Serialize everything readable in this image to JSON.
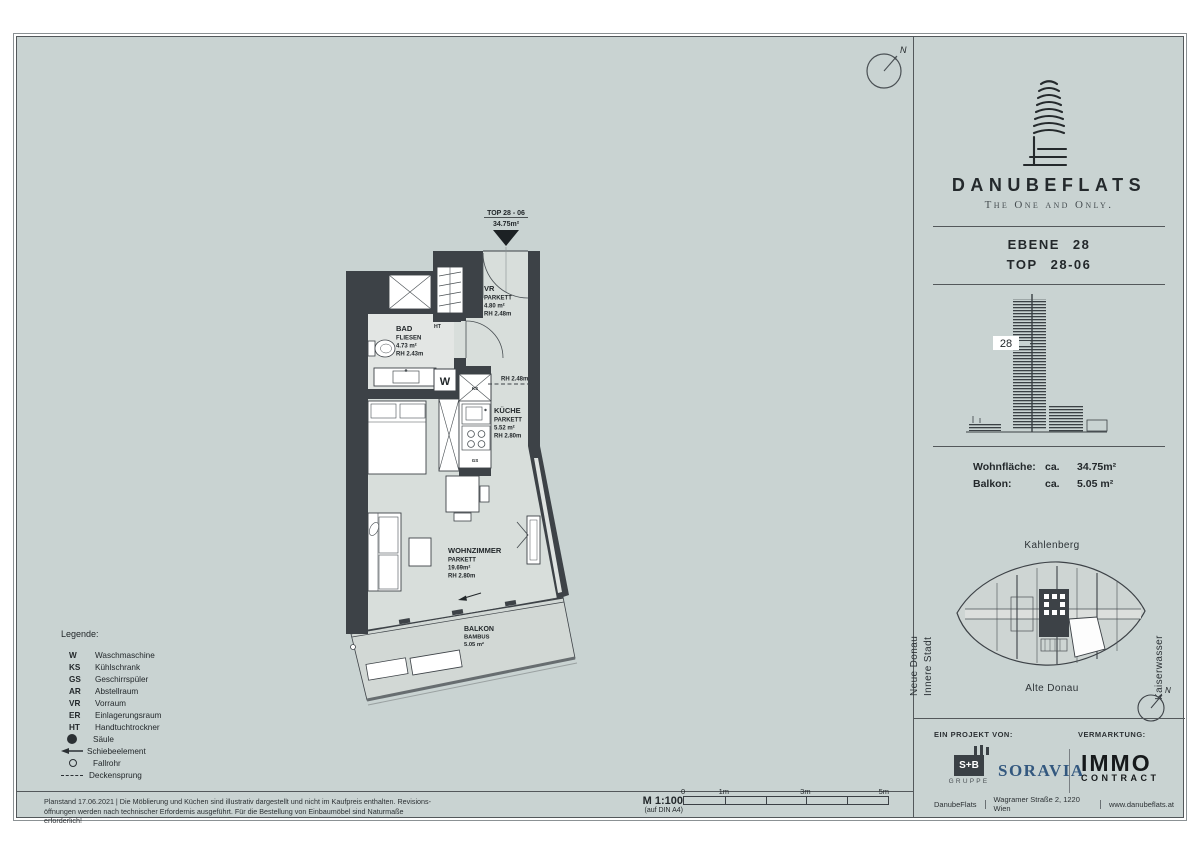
{
  "colors": {
    "sheet_bg": "#c9d3d2",
    "wall": "#3d4247",
    "soravia_blue": "#33587f",
    "immo_black": "#16191b",
    "sb_logo_bg": "#3a4045"
  },
  "north_label": "N",
  "plan": {
    "callout": {
      "line1": "TOP 28 - 06",
      "line2": "34.75m²"
    },
    "rooms": {
      "vr": {
        "name": "VR",
        "floor": "PARKETT",
        "area": "4.80 m²",
        "rh": "RH 2.48m"
      },
      "bad": {
        "name": "BAD",
        "floor": "FLIESEN",
        "area": "4.73 m²",
        "rh": "RH 2.43m"
      },
      "kueche": {
        "name": "KÜCHE",
        "floor": "PARKETT",
        "area": "5.52 m²",
        "rh": "RH 2.80m"
      },
      "wohnzimmer": {
        "name": "WOHNZIMMER",
        "floor": "PARKETT",
        "area": "19.69m²",
        "rh": "RH 2.80m"
      },
      "balkon": {
        "name": "BALKON",
        "floor": "BAMBUS",
        "area": "5.05 m²"
      }
    },
    "marks": {
      "ht": "HT",
      "w": "W",
      "ks": "KS",
      "gs": "GS",
      "deckensprung": "RH 2.48m"
    }
  },
  "legend": {
    "title": "Legende:",
    "items": [
      {
        "abbr": "W",
        "label": "Waschmaschine"
      },
      {
        "abbr": "KS",
        "label": "Kühlschrank"
      },
      {
        "abbr": "GS",
        "label": "Geschirrspüler"
      },
      {
        "abbr": "AR",
        "label": "Abstellraum"
      },
      {
        "abbr": "VR",
        "label": "Vorraum"
      },
      {
        "abbr": "ER",
        "label": "Einlagerungsraum"
      },
      {
        "abbr": "HT",
        "label": "Handtuchtrockner"
      }
    ],
    "symbols": [
      {
        "label": "Säule"
      },
      {
        "label": "Schiebeelement"
      },
      {
        "label": "Fallrohr"
      },
      {
        "label": "Deckensprung"
      }
    ]
  },
  "footer": {
    "note_line1": "Planstand 17.06.2021 | Die Möblierung und Küchen sind illustrativ dargestellt und nicht im Kaufpreis enthalten. Revisions-",
    "note_line2": "öffnungen werden nach technischer Erfordernis ausgeführt. Für die Bestellung von Einbaumöbel sind Naturmaße erforderlich!",
    "scale": {
      "label": "M 1:100",
      "sub": "(auf DIN A4)",
      "t0": "0",
      "t1": "1m",
      "t3": "3m",
      "t5": "5m"
    }
  },
  "sidebar": {
    "brand": {
      "name": "DANUBEFLATS",
      "tagline": "The One and Only."
    },
    "unit": {
      "level_label": "EBENE",
      "level_value": "28",
      "top_label": "TOP",
      "top_value": "28-06"
    },
    "elevation": {
      "floor": "28"
    },
    "areas": {
      "w_label": "Wohnfläche:",
      "w_ca": "ca.",
      "w_value": "34.75m²",
      "b_label": "Balkon:",
      "b_ca": "ca.",
      "b_value": "5.05 m²"
    },
    "map": {
      "north": "Kahlenberg",
      "west1": "Neue Donau",
      "west2": "Innere Stadt",
      "east": "Kaiserwasser",
      "south": "Alte Donau"
    },
    "partners": {
      "project_label": "EIN PROJEKT VON:",
      "marketing_label": "VERMARKTUNG:",
      "sb_name": "S+B",
      "sb_sub": "GRUPPE",
      "soravia": "SORAVIA",
      "immo_line1": "IMMO",
      "immo_line2": "CONTRACT",
      "address_brand": "DanubeFlats",
      "address_street": "Wagramer Straße 2, 1220 Wien",
      "address_web": "www.danubeflats.at"
    }
  }
}
